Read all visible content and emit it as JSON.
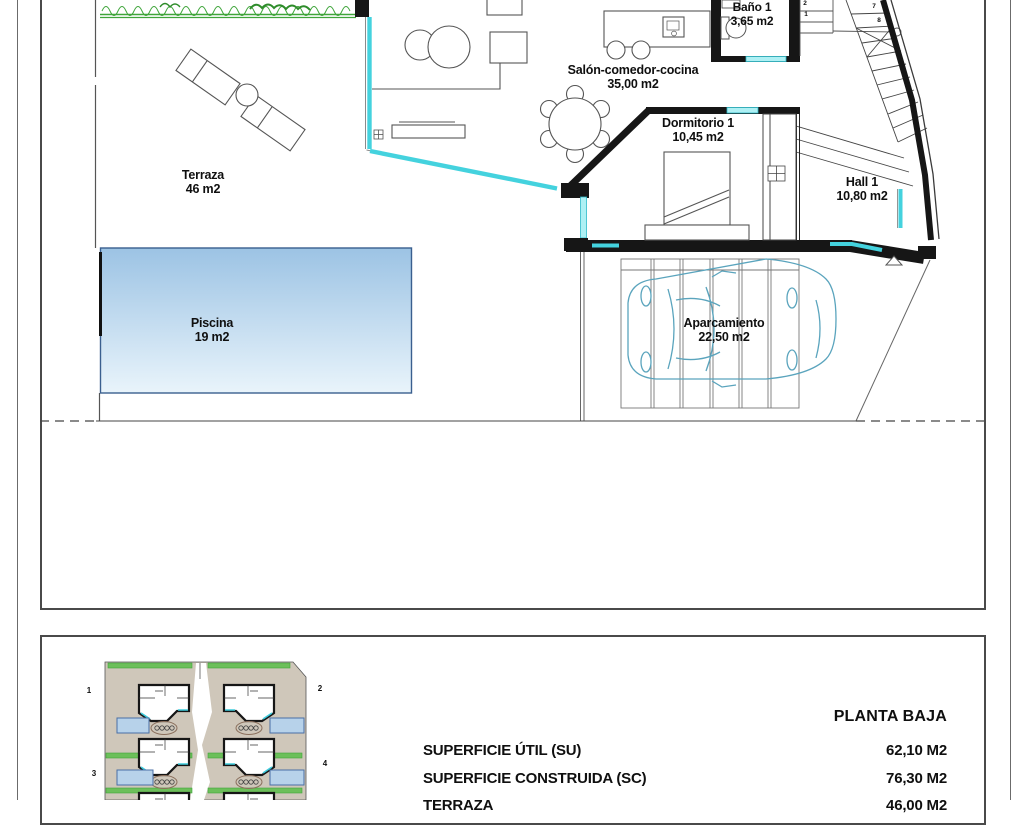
{
  "floor_plan": {
    "rooms": [
      {
        "name": "Terraza",
        "area": "46 m2"
      },
      {
        "name": "Piscina",
        "area": "19 m2"
      },
      {
        "name": "Salón-comedor-cocina",
        "area": "35,00 m2"
      },
      {
        "name": "Baño 1",
        "area": "3,65 m2"
      },
      {
        "name": "Dormitorio 1",
        "area": "10,45 m2"
      },
      {
        "name": "Hall 1",
        "area": "10,80 m2"
      },
      {
        "name": "Aparcamiento",
        "area": "22,50 m2"
      }
    ],
    "stair_step_numbers": {
      "upper": [
        "2",
        "1"
      ],
      "flight": [
        "7",
        "8"
      ]
    }
  },
  "site_plan": {
    "plot_numbers": [
      "1",
      "2",
      "3",
      "4"
    ]
  },
  "summary": {
    "title": "PLANTA BAJA",
    "rows": [
      {
        "label": "SUPERFICIE ÚTIL (SU)",
        "value": "62,10 M2"
      },
      {
        "label": "SUPERFICIE CONSTRUIDA (SC)",
        "value": "76,30 M2"
      },
      {
        "label": "TERRAZA",
        "value": "46,00 M2"
      }
    ]
  },
  "colors": {
    "wall_black": "#161616",
    "glass_cyan": "#44d2de",
    "hedge_green": "#3fa53a",
    "pool_blue_top": "#9cc3e4",
    "pool_blue_bottom": "#e9f4fb",
    "pool_border": "#3a5f8f",
    "car_teal": "#5aa4bd",
    "site_tan": "#cfc7ba",
    "thumb_pool_blue": "#b7d2ea"
  }
}
